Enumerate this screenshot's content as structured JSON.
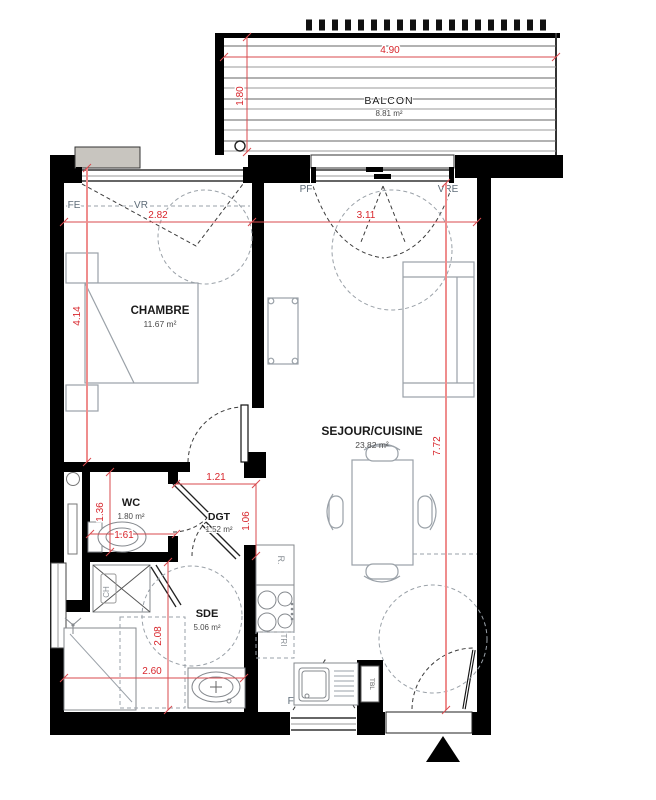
{
  "plan": {
    "rooms": {
      "balcon": {
        "name": "BALCON",
        "area": "8.81 m²"
      },
      "chambre": {
        "name": "CHAMBRE",
        "area": "11.67 m²"
      },
      "sejour": {
        "name": "SEJOUR/CUISINE",
        "area": "23.82 m²"
      },
      "wc": {
        "name": "WC",
        "area": "1.80 m²"
      },
      "dgt": {
        "name": "DGT",
        "area": "1.52 m²"
      },
      "sde": {
        "name": "SDE",
        "area": "5.06 m²"
      }
    },
    "dimensions": {
      "balcony_width": "4.90",
      "balcony_depth": "1.80",
      "chambre_width": "2.82",
      "sejour_width": "3.11",
      "chambre_height": "4.14",
      "sejour_height": "7.72",
      "dgt_width": "1.21",
      "dgt_height": "1.06",
      "wc_height": "1.36",
      "wc_width": "1.61",
      "sde_height": "2.08",
      "sde_width": "2.60"
    },
    "openings": {
      "chambre_window": {
        "type": "FE",
        "shutter": "VR"
      },
      "sejour_bay": {
        "type": "PF",
        "shutter": "VRE"
      },
      "kitchen_window": {
        "type": "FE",
        "shutter": "VR"
      }
    },
    "equipment": {
      "fridge": "R.",
      "sorting": "TRI",
      "water_heater": "CH",
      "electrical_panel": "TBL"
    },
    "colors": {
      "wall_black": "#000000",
      "dimension_red": "#d8262c",
      "opening_label_gray": "#5d6b77",
      "furniture_gray": "#9aa1a8"
    }
  }
}
